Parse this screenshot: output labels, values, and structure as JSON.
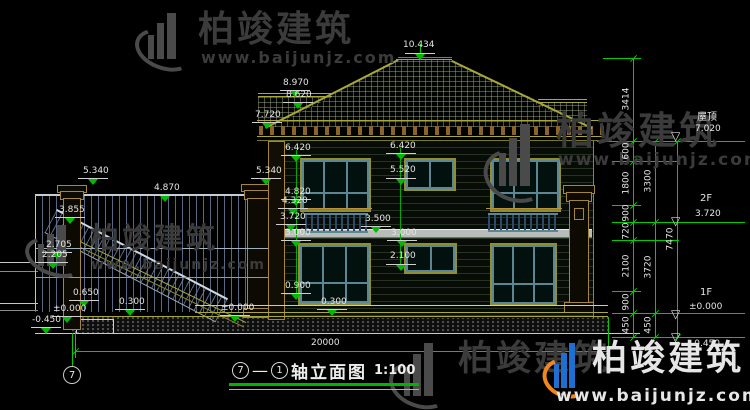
{
  "watermark": {
    "name": "柏竣建筑",
    "url": "www.baijunjz.com"
  },
  "title": {
    "axis_a": "7",
    "separator": "—",
    "axis_b": "1",
    "text": "轴立面图",
    "scale": "1:100"
  },
  "axis_bubble": {
    "label": "7"
  },
  "colors": {
    "dim_green": "#00cc00",
    "outline_yellow": "#a8a83a",
    "window_teal": "#5a8793",
    "pillar_tan": "#a5853a",
    "logo_blue": "#1f6fd0",
    "logo_orange": "#f0861e"
  },
  "drawing": {
    "annotations": [
      {
        "t": "5.340",
        "x": 83,
        "y": 167
      },
      {
        "t": "4.870",
        "x": 154,
        "y": 184
      },
      {
        "t": "5.340",
        "x": 256,
        "y": 167
      },
      {
        "t": "3.855",
        "x": 59,
        "y": 206
      },
      {
        "t": "2.705",
        "x": 46,
        "y": 241
      },
      {
        "t": "2.205",
        "x": 42,
        "y": 251
      },
      {
        "t": "0.650",
        "x": 73,
        "y": 289
      },
      {
        "t": "0.300",
        "x": 119,
        "y": 298
      },
      {
        "t": "±0.000",
        "x": 53,
        "y": 305
      },
      {
        "t": "-0.450",
        "x": 32,
        "y": 316
      },
      {
        "t": "8.970",
        "x": 283,
        "y": 79
      },
      {
        "t": "8.620",
        "x": 286,
        "y": 91
      },
      {
        "t": "7.720",
        "x": 255,
        "y": 111
      },
      {
        "t": "6.420",
        "x": 285,
        "y": 144
      },
      {
        "t": "4.820",
        "x": 285,
        "y": 188
      },
      {
        "t": "4.320",
        "x": 282,
        "y": 197
      },
      {
        "t": "3.720",
        "x": 280,
        "y": 213
      },
      {
        "t": "3.000",
        "x": 285,
        "y": 229
      },
      {
        "t": "0.900",
        "x": 285,
        "y": 282
      },
      {
        "t": "0.300",
        "x": 321,
        "y": 298
      },
      {
        "t": "±0.000",
        "x": 221,
        "y": 304
      },
      {
        "t": "10.434",
        "x": 403,
        "y": 41
      },
      {
        "t": "6.420",
        "x": 390,
        "y": 142
      },
      {
        "t": "5.520",
        "x": 390,
        "y": 166
      },
      {
        "t": "3.500",
        "x": 365,
        "y": 215
      },
      {
        "t": "3.000",
        "x": 391,
        "y": 229
      },
      {
        "t": "2.100",
        "x": 390,
        "y": 252
      },
      {
        "t": "屋顶",
        "x": 697,
        "y": 113,
        "s": 10
      },
      {
        "t": "7.020",
        "x": 695,
        "y": 125
      },
      {
        "t": "2F",
        "x": 700,
        "y": 194,
        "s": 10
      },
      {
        "t": "3.720",
        "x": 695,
        "y": 210
      },
      {
        "t": "1F",
        "x": 700,
        "y": 288,
        "s": 10
      },
      {
        "t": "±0.000",
        "x": 689,
        "y": 303
      },
      {
        "t": "-0.450",
        "x": 691,
        "y": 340
      },
      {
        "t": "20000",
        "x": 311,
        "y": 339
      },
      {
        "t": "3414",
        "x": 627,
        "y": 99,
        "r": 1
      },
      {
        "t": "600",
        "x": 627,
        "y": 151,
        "r": 1
      },
      {
        "t": "1800",
        "x": 627,
        "y": 183,
        "r": 1
      },
      {
        "t": "900",
        "x": 627,
        "y": 213,
        "r": 1
      },
      {
        "t": "720",
        "x": 627,
        "y": 231,
        "r": 1
      },
      {
        "t": "2100",
        "x": 627,
        "y": 266,
        "r": 1
      },
      {
        "t": "900",
        "x": 627,
        "y": 302,
        "r": 1
      },
      {
        "t": "450",
        "x": 627,
        "y": 325,
        "r": 1
      },
      {
        "t": "3300",
        "x": 649,
        "y": 181,
        "r": 1
      },
      {
        "t": "3720",
        "x": 649,
        "y": 267,
        "r": 1
      },
      {
        "t": "450",
        "x": 649,
        "y": 325,
        "r": 1
      },
      {
        "t": "7470",
        "x": 671,
        "y": 239,
        "r": 1
      }
    ],
    "markers": [
      {
        "x": 93,
        "y": 178
      },
      {
        "x": 165,
        "y": 195
      },
      {
        "x": 266,
        "y": 178
      },
      {
        "x": 70,
        "y": 217
      },
      {
        "x": 57,
        "y": 252
      },
      {
        "x": 53,
        "y": 262
      },
      {
        "x": 84,
        "y": 300
      },
      {
        "x": 130,
        "y": 309
      },
      {
        "x": 67,
        "y": 316
      },
      {
        "x": 46,
        "y": 327
      },
      {
        "x": 295,
        "y": 90
      },
      {
        "x": 298,
        "y": 102
      },
      {
        "x": 267,
        "y": 122
      },
      {
        "x": 296,
        "y": 155
      },
      {
        "x": 296,
        "y": 199
      },
      {
        "x": 293,
        "y": 208
      },
      {
        "x": 291,
        "y": 224
      },
      {
        "x": 296,
        "y": 240
      },
      {
        "x": 296,
        "y": 293
      },
      {
        "x": 332,
        "y": 309
      },
      {
        "x": 235,
        "y": 315
      },
      {
        "x": 420,
        "y": 53
      },
      {
        "x": 401,
        "y": 153
      },
      {
        "x": 401,
        "y": 178
      },
      {
        "x": 376,
        "y": 226
      },
      {
        "x": 402,
        "y": 240
      },
      {
        "x": 401,
        "y": 264
      }
    ],
    "open_markers": [
      {
        "x": 671,
        "y": 130
      },
      {
        "x": 671,
        "y": 215
      },
      {
        "x": 671,
        "y": 308
      },
      {
        "x": 671,
        "y": 331
      }
    ],
    "hlines": [
      {
        "x": 398,
        "y": 57,
        "w": 54,
        "c": "#00cc00"
      },
      {
        "x": 603,
        "y": 58,
        "w": 38,
        "c": "#00cc00"
      },
      {
        "x": 597,
        "y": 141,
        "w": 148,
        "c": "#00cc00"
      },
      {
        "x": 612,
        "y": 161,
        "w": 67,
        "c": "#00cc00"
      },
      {
        "x": 612,
        "y": 205,
        "w": 29,
        "c": "#00cc00"
      },
      {
        "x": 612,
        "y": 222,
        "w": 133,
        "c": "#00cc00"
      },
      {
        "x": 612,
        "y": 240,
        "w": 67,
        "c": "#00cc00"
      },
      {
        "x": 612,
        "y": 291,
        "w": 29,
        "c": "#00cc00"
      },
      {
        "x": 612,
        "y": 313,
        "w": 133,
        "c": "#00cc00"
      },
      {
        "x": 612,
        "y": 337,
        "w": 133,
        "c": "#00cc00"
      },
      {
        "x": 75,
        "y": 351,
        "w": 533,
        "c": "#00cc00"
      },
      {
        "x": 396,
        "y": 59,
        "w": 56,
        "c": "#a8a83a"
      },
      {
        "x": 258,
        "y": 93,
        "w": 74,
        "c": "#a8a83a"
      },
      {
        "x": 258,
        "y": 96,
        "w": 74,
        "c": "#a8a83a"
      },
      {
        "x": 538,
        "y": 99,
        "w": 49,
        "c": "#a8a83a"
      },
      {
        "x": 538,
        "y": 102,
        "w": 49,
        "c": "#a8a83a"
      },
      {
        "x": 35,
        "y": 248,
        "w": 233,
        "c": "#9fb0bf"
      },
      {
        "x": 35,
        "y": 277,
        "w": 233,
        "c": "#8e9aa8"
      },
      {
        "x": 195,
        "y": 305,
        "w": 413,
        "c": "#c9c9c9"
      },
      {
        "x": 195,
        "y": 312,
        "w": 413,
        "c": "#a8a83a"
      },
      {
        "x": 72,
        "y": 316,
        "w": 536,
        "c": "#a8a83a"
      },
      {
        "x": 35,
        "y": 333,
        "w": 605,
        "c": "#c8c8c8"
      },
      {
        "x": 296,
        "y": 208,
        "w": 76,
        "c": "#b8913f"
      },
      {
        "x": 486,
        "y": 208,
        "w": 76,
        "c": "#b8913f"
      }
    ],
    "vlines": [
      {
        "x": 35,
        "y": 194,
        "h": 116,
        "c": "#b9c4cf"
      },
      {
        "x": 296,
        "y": 150,
        "h": 146,
        "c": "#00aa00"
      },
      {
        "x": 400,
        "y": 148,
        "h": 118,
        "c": "#00aa00"
      },
      {
        "x": 420,
        "y": 44,
        "h": 13,
        "c": "#00cc00"
      },
      {
        "x": 633,
        "y": 58,
        "h": 279,
        "c": "#00cc00"
      },
      {
        "x": 655,
        "y": 141,
        "h": 196,
        "c": "#00cc00"
      },
      {
        "x": 677,
        "y": 141,
        "h": 196,
        "c": "#00cc00"
      },
      {
        "x": 75,
        "y": 331,
        "h": 27,
        "c": "#00cc00"
      },
      {
        "x": 608,
        "y": 317,
        "h": 41,
        "c": "#00cc00"
      },
      {
        "x": 72,
        "y": 333,
        "h": 33,
        "c": "#00cc00"
      }
    ],
    "ticks": [
      {
        "x": 633,
        "ys": [
          58,
          141,
          161,
          205,
          222,
          240,
          291,
          313,
          337
        ]
      },
      {
        "x": 655,
        "ys": [
          141,
          222,
          313,
          337
        ]
      },
      {
        "x": 677,
        "ys": [
          141,
          337
        ]
      },
      {
        "x": 75,
        "ys": [
          351
        ]
      },
      {
        "x": 608,
        "ys": [
          351
        ]
      }
    ]
  }
}
